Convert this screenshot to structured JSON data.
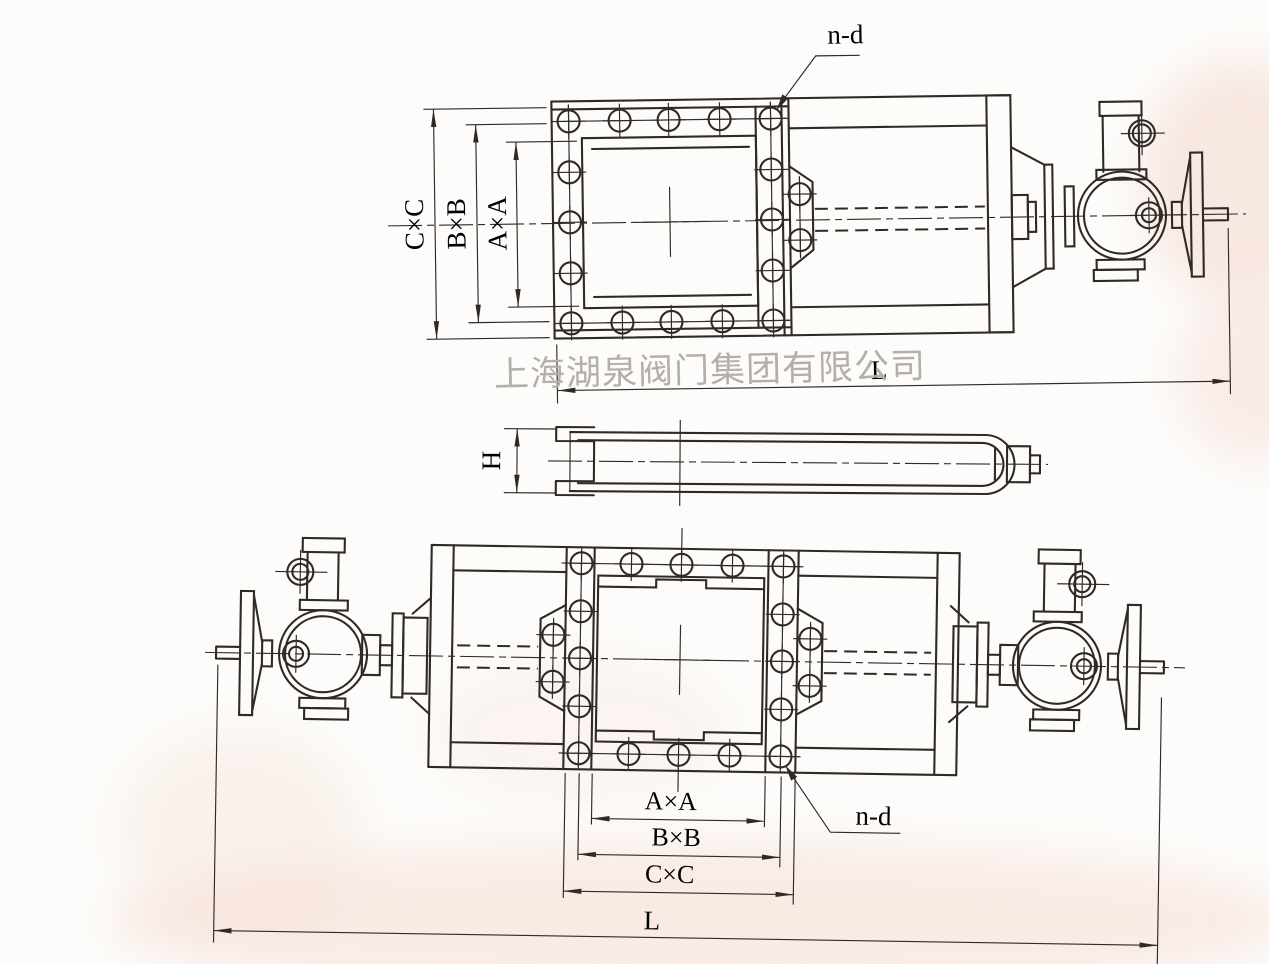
{
  "document": {
    "kind": "valve dimensional drawing",
    "watermark": "上海湖泉阀门集团有限公司"
  },
  "colors": {
    "ink": "#2e2a26",
    "watermark_gray": "#b3afab",
    "paper": "#fdfcfa"
  },
  "labels": {
    "top_view": {
      "bolt_note": "n-d",
      "outer": "C×C",
      "middle": "B×B",
      "inner": "A×A",
      "length": "L"
    },
    "plan_view": {
      "height": "H"
    },
    "bottom_view": {
      "inner": "A×A",
      "middle": "B×B",
      "outer": "C×C",
      "bolt_note": "n-d",
      "length": "L"
    }
  }
}
